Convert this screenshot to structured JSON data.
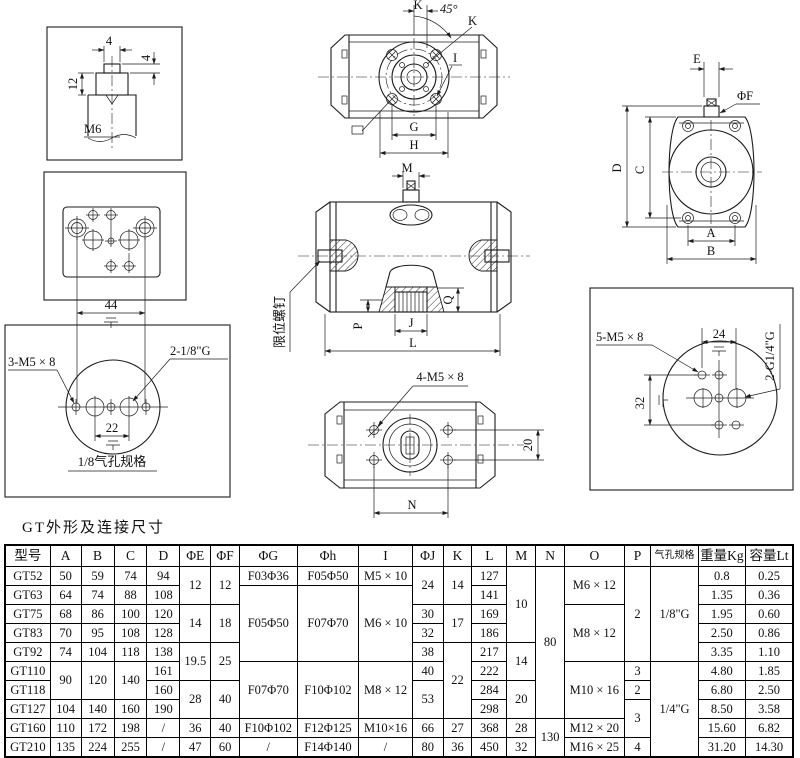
{
  "page": {
    "section_title": "GT外形及连接尺寸"
  },
  "diagrams": {
    "shaft_detail": {
      "dim_width_top": "4",
      "dim_width_right": "4",
      "dim_height": "12",
      "thread_label": "M6"
    },
    "mounting_pad": {
      "dim_span": "44"
    },
    "air_port_18": {
      "holes_label": "3-M5 × 8",
      "port_label": "2-1/8\"G",
      "dim_span": "22",
      "caption": "1/8气孔规格"
    },
    "top_view": {
      "dim_k": "K",
      "angle_label": "45°",
      "dim_k2": "K",
      "hole_label": "I",
      "dim_g": "G",
      "dim_h": "H"
    },
    "front_view": {
      "dim_m": "M",
      "limit_screw_label": "限位螺钉",
      "dim_p": "P",
      "dim_j": "J",
      "dim_q": "Q",
      "dim_l": "L"
    },
    "bottom_view": {
      "holes_label": "4-M5 × 8",
      "dim_n": "N",
      "dim_height": "20"
    },
    "side_view": {
      "dim_e": "E",
      "dim_f": "ΦF",
      "dim_d": "D",
      "dim_c": "C",
      "dim_a": "A",
      "dim_b": "B"
    },
    "air_port_14": {
      "holes_label": "5-M5 × 8",
      "dim_top": "24",
      "port_label": "2-G1/4\"G",
      "dim_left": "32"
    }
  },
  "table": {
    "row_count": 10,
    "columns": [
      {
        "header": "型号",
        "cells": [
          [
            "GT52",
            1
          ],
          [
            "GT63",
            1
          ],
          [
            "GT75",
            1
          ],
          [
            "GT83",
            1
          ],
          [
            "GT92",
            1
          ],
          [
            "GT110",
            1
          ],
          [
            "GT118",
            1
          ],
          [
            "GT127",
            1
          ],
          [
            "GT160",
            1
          ],
          [
            "GT210",
            1
          ]
        ]
      },
      {
        "header": "A",
        "cells": [
          [
            "50",
            1
          ],
          [
            "64",
            1
          ],
          [
            "68",
            1
          ],
          [
            "70",
            1
          ],
          [
            "74",
            1
          ],
          [
            "90",
            2
          ],
          [
            "104",
            1
          ],
          [
            "110",
            1
          ],
          [
            "135",
            1
          ]
        ]
      },
      {
        "header": "B",
        "cells": [
          [
            "59",
            1
          ],
          [
            "74",
            1
          ],
          [
            "86",
            1
          ],
          [
            "95",
            1
          ],
          [
            "104",
            1
          ],
          [
            "120",
            2
          ],
          [
            "140",
            1
          ],
          [
            "172",
            1
          ],
          [
            "224",
            1
          ]
        ]
      },
      {
        "header": "C",
        "cells": [
          [
            "74",
            1
          ],
          [
            "88",
            1
          ],
          [
            "100",
            1
          ],
          [
            "108",
            1
          ],
          [
            "118",
            1
          ],
          [
            "140",
            2
          ],
          [
            "160",
            1
          ],
          [
            "198",
            1
          ],
          [
            "255",
            1
          ]
        ]
      },
      {
        "header": "D",
        "cells": [
          [
            "94",
            1
          ],
          [
            "108",
            1
          ],
          [
            "120",
            1
          ],
          [
            "128",
            1
          ],
          [
            "138",
            1
          ],
          [
            "161",
            1
          ],
          [
            "160",
            1
          ],
          [
            "190",
            1
          ],
          [
            "/",
            1
          ],
          [
            "/",
            1
          ]
        ]
      },
      {
        "header": "ΦE",
        "cells": [
          [
            "12",
            2
          ],
          [
            "14",
            2
          ],
          [
            "19.5",
            2
          ],
          [
            "28",
            2
          ],
          [
            "36",
            1
          ],
          [
            "47",
            1
          ]
        ]
      },
      {
        "header": "ΦF",
        "cells": [
          [
            "12",
            2
          ],
          [
            "18",
            2
          ],
          [
            "25",
            2
          ],
          [
            "40",
            2
          ],
          [
            "40",
            1
          ],
          [
            "60",
            1
          ]
        ]
      },
      {
        "header": "ΦG",
        "cells": [
          [
            "F03Φ36",
            1
          ],
          [
            "F05Φ50",
            4
          ],
          [
            "F07Φ70",
            3
          ],
          [
            "F10Φ102",
            1
          ],
          [
            "/",
            1
          ]
        ]
      },
      {
        "header": "Φh",
        "cells": [
          [
            "F05Φ50",
            1
          ],
          [
            "F07Φ70",
            4
          ],
          [
            "F10Φ102",
            3
          ],
          [
            "F12Φ125",
            1
          ],
          [
            "F14Φ140",
            1
          ]
        ]
      },
      {
        "header": "I",
        "cells": [
          [
            "M5 × 10",
            1
          ],
          [
            "M6 × 10",
            4
          ],
          [
            "M8 × 12",
            3
          ],
          [
            "M10×16",
            1
          ],
          [
            "/",
            1
          ]
        ]
      },
      {
        "header": "ΦJ",
        "cells": [
          [
            "24",
            2
          ],
          [
            "30",
            1
          ],
          [
            "32",
            1
          ],
          [
            "38",
            1
          ],
          [
            "40",
            1
          ],
          [
            "53",
            2
          ],
          [
            "66",
            1
          ],
          [
            "80",
            1
          ]
        ]
      },
      {
        "header": "K",
        "cells": [
          [
            "14",
            2
          ],
          [
            "17",
            2
          ],
          [
            "22",
            4
          ],
          [
            "27",
            1
          ],
          [
            "36",
            1
          ]
        ]
      },
      {
        "header": "L",
        "cells": [
          [
            "127",
            1
          ],
          [
            "141",
            1
          ],
          [
            "169",
            1
          ],
          [
            "186",
            1
          ],
          [
            "217",
            1
          ],
          [
            "222",
            1
          ],
          [
            "284",
            1
          ],
          [
            "298",
            1
          ],
          [
            "368",
            1
          ],
          [
            "450",
            1
          ]
        ]
      },
      {
        "header": "M",
        "cells": [
          [
            "10",
            4
          ],
          [
            "14",
            2
          ],
          [
            "20",
            2
          ],
          [
            "28",
            1
          ],
          [
            "32",
            1
          ]
        ]
      },
      {
        "header": "N",
        "cells": [
          [
            "80",
            8
          ],
          [
            "130",
            2
          ]
        ]
      },
      {
        "header": "O",
        "cells": [
          [
            "M6 × 12",
            2
          ],
          [
            "M8 × 12",
            3
          ],
          [
            "M10 × 16",
            3
          ],
          [
            "M12 × 20",
            1
          ],
          [
            "M16 × 25",
            1
          ]
        ]
      },
      {
        "header": "P",
        "cells": [
          [
            "2",
            5
          ],
          [
            "3",
            1
          ],
          [
            "2",
            1
          ],
          [
            "3",
            2
          ],
          [
            "4",
            1
          ]
        ]
      },
      {
        "header": "气孔规格",
        "cells": [
          [
            "1/8\"G",
            5
          ],
          [
            "1/4\"G",
            5
          ]
        ]
      },
      {
        "header": "重量Kg",
        "cells": [
          [
            "0.8",
            1
          ],
          [
            "1.35",
            1
          ],
          [
            "1.95",
            1
          ],
          [
            "2.50",
            1
          ],
          [
            "3.35",
            1
          ],
          [
            "4.80",
            1
          ],
          [
            "6.80",
            1
          ],
          [
            "8.50",
            1
          ],
          [
            "15.60",
            1
          ],
          [
            "31.20",
            1
          ]
        ]
      },
      {
        "header": "容量Lt",
        "cells": [
          [
            "0.25",
            1
          ],
          [
            "0.36",
            1
          ],
          [
            "0.60",
            1
          ],
          [
            "0.86",
            1
          ],
          [
            "1.10",
            1
          ],
          [
            "1.85",
            1
          ],
          [
            "2.50",
            1
          ],
          [
            "3.58",
            1
          ],
          [
            "6.82",
            1
          ],
          [
            "14.30",
            1
          ]
        ]
      }
    ]
  }
}
